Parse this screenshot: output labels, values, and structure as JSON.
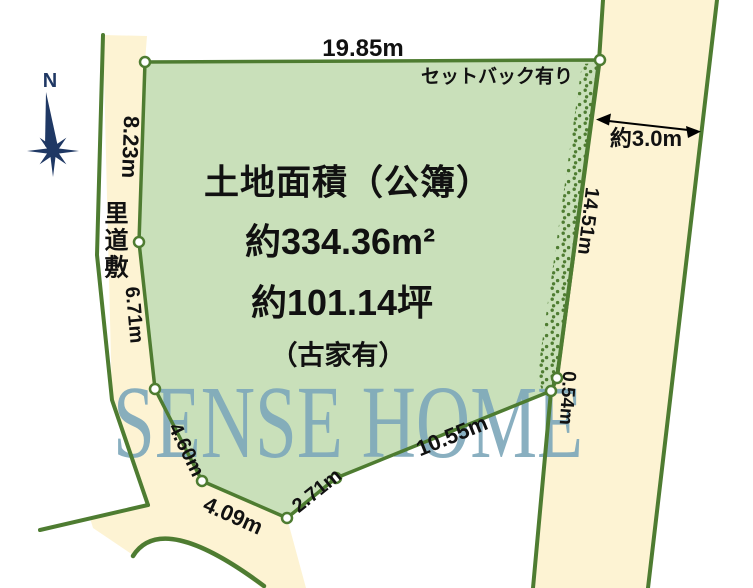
{
  "colors": {
    "background": "#ffffff",
    "plot_fill": "#c9e0ba",
    "road_fill": "#fdf3d3",
    "line_green": "#4e7c31",
    "compass_navy": "#1f3864",
    "watermark_blue": "#7fa9bb",
    "text_black": "#111111"
  },
  "compass": {
    "north_label": "N"
  },
  "land_info": {
    "title": "土地面積（公簿）",
    "area_sqm": "約334.36m²",
    "area_tsubo": "約101.14坪",
    "note": "（古家有）"
  },
  "roads": {
    "left_road_name": "里道敷",
    "right_road_width": "約3.0m",
    "setback_note": "セットバック有り"
  },
  "measurements": {
    "top": "19.85m",
    "left_upper": "8.23m",
    "left_middle": "6.71m",
    "left_lower": "4.60m",
    "bottom_left": "4.09m",
    "bottom_middle": "2.71m",
    "bottom_right": "10.55m",
    "right_lower": "0.54m",
    "right_main": "14.51m"
  },
  "watermark": "SENSE HOME"
}
